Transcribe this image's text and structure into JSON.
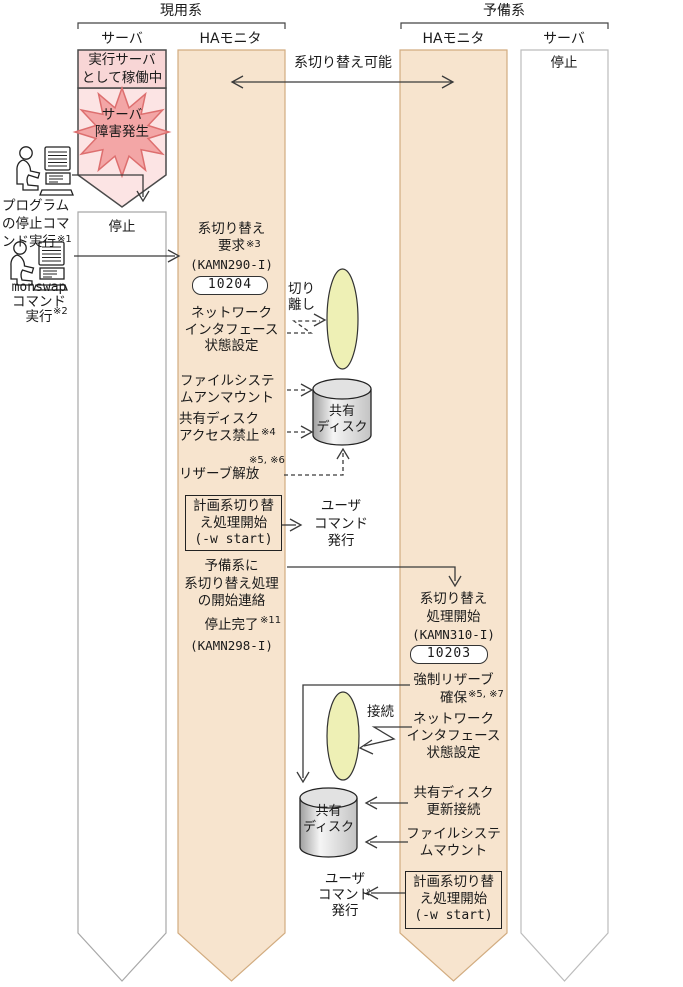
{
  "colors": {
    "column_beige": "#f7e4ce",
    "column_beige_border": "#d2ac80",
    "white_column_border": "#bcbcbc",
    "pink_box": "#f8d6d6",
    "pink_arrow": "#fce4e4",
    "star_fill": "#f3a6a6",
    "star_stroke": "#dd6f6f",
    "ellipse_fill": "#eef0b5",
    "line": "#3a3a3a"
  },
  "header": {
    "active_system": "現用系",
    "standby_system": "予備系",
    "col_server_active": "サーバ",
    "col_monitor_active": "HAモニタ",
    "col_monitor_standby": "HAモニタ",
    "col_server_standby": "サーバ"
  },
  "active_server": {
    "running": "実行サーバ\nとして稼働中",
    "failure": "サーバ\n障害発生",
    "stopped": "停止"
  },
  "standby_server": {
    "stopped": "停止"
  },
  "actors": {
    "program_stop": "プログラム\nの停止コマ\nンド実行",
    "program_stop_note": "※1",
    "monswap_cmd": "monswap",
    "monswap_rest": "コマンド\n実行",
    "monswap_note": "※2"
  },
  "mid": {
    "switchable": "系切り替え可能",
    "disconnect": "切り\n離し",
    "connect": "接続",
    "user_command_top": "ユーザ\nコマンド\n発行",
    "user_command_bottom": "ユーザ\nコマンド\n発行",
    "shared_disk_top": "共有\nディスク",
    "shared_disk_bottom": "共有\nディスク"
  },
  "active_monitor": {
    "switch_request": "系切り替え\n要求",
    "switch_request_note": "※3",
    "switch_request_msgid": "(KAMN290-I)",
    "switch_request_code": "10204",
    "network_setting": "ネットワーク\nインタフェース\n状態設定",
    "fs_unmount": "ファイルシステ\nムアンマウント",
    "disk_forbid": "共有ディスク\nアクセス禁止",
    "disk_forbid_note": "※4",
    "reserve_release": "リザーブ解放",
    "reserve_release_note": "※5, ※6",
    "planned_switch": "計画系切り替\nえ処理開始",
    "planned_switch_cmd": "(-w start)",
    "notify_standby": "予備系に\n系切り替え処理\nの開始連絡",
    "stop_complete": "停止完了",
    "stop_complete_note": "※11",
    "stop_complete_msgid": "(KAMN298-I)"
  },
  "standby_monitor": {
    "switch_start": "系切り替え\n処理開始",
    "switch_start_msgid": "(KAMN310-I)",
    "switch_start_code": "10203",
    "force_reserve": "強制リザーブ\n確保",
    "force_reserve_note": "※5, ※7",
    "network_setting": "ネットワーク\nインタフェース\n状態設定",
    "disk_update_connect": "共有ディスク\n更新接続",
    "fs_mount": "ファイルシステ\nムマウント",
    "planned_switch": "計画系切り替\nえ処理開始",
    "planned_switch_cmd": "(-w start)"
  }
}
